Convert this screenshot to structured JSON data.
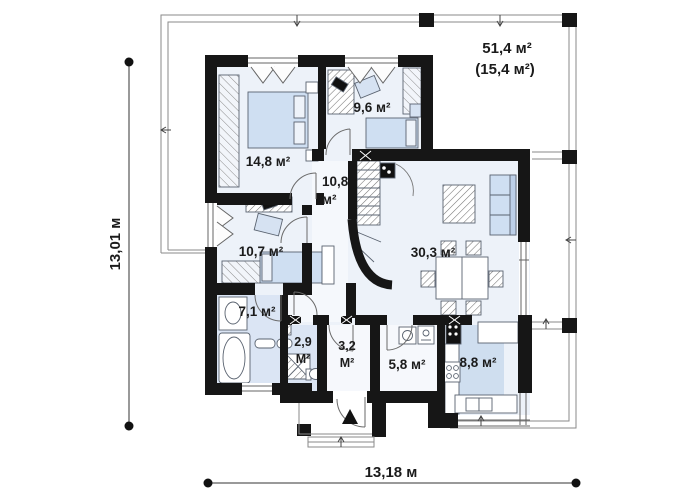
{
  "plan": {
    "terrace": {
      "area_total": "51,4 м²",
      "area_secondary": "(15,4 м²)"
    },
    "rooms": {
      "bedroom_1": {
        "area": "14,8 м²"
      },
      "bedroom_2": {
        "area": "9,6 м²"
      },
      "hall": {
        "value": "10,8",
        "unit": "м²"
      },
      "bedroom_3": {
        "area": "10,7 м²"
      },
      "bathroom": {
        "area": "7,1 м²"
      },
      "wc": {
        "value": "2,9",
        "unit": "М²"
      },
      "vestibule": {
        "value": "3,2",
        "unit": "М²"
      },
      "utility": {
        "area": "5,8 м²"
      },
      "kitchen": {
        "area": "8,8 м²"
      },
      "living_room": {
        "area": "30,3 м²"
      }
    },
    "dimensions": {
      "height": "13,01 м",
      "width": "13,18 м"
    },
    "colors": {
      "wall": "#161616",
      "floor": "#edf2f9",
      "floor_accent": "#cfdeef",
      "furniture": "#cfdff2",
      "outline": "#888888"
    }
  }
}
